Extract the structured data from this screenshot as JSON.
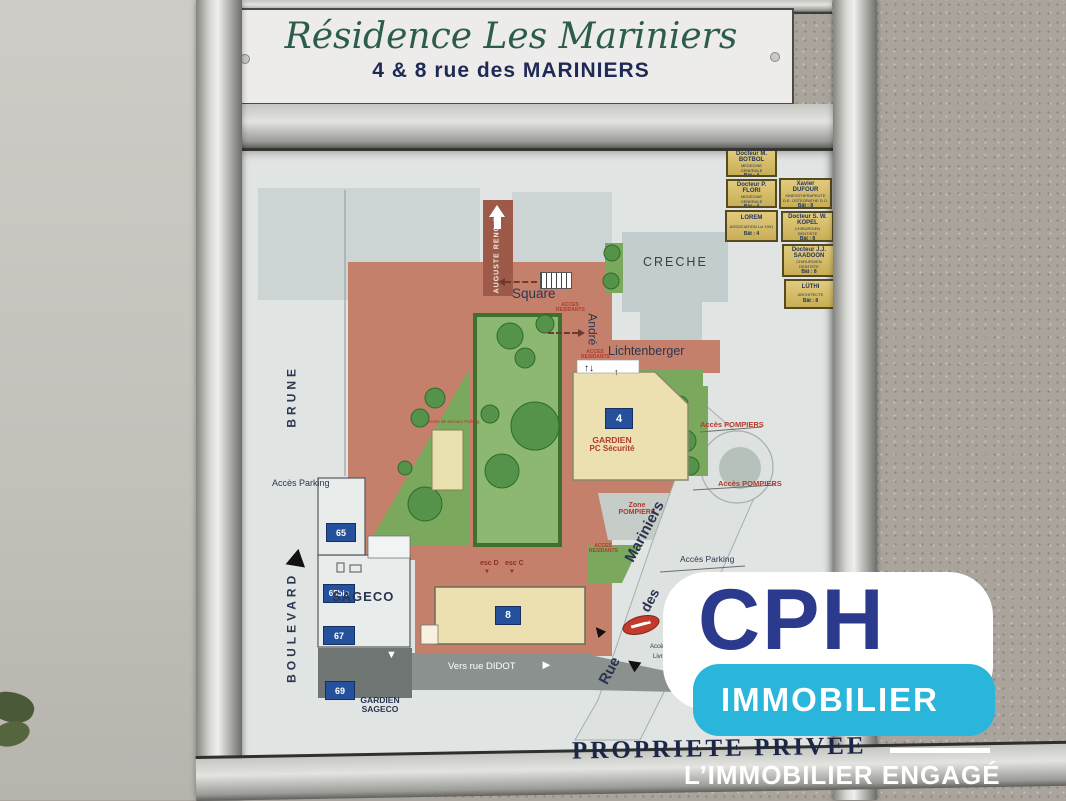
{
  "sign": {
    "title": "Résidence Les Mariniers",
    "subtitle": "4 & 8 rue des MARINIERS"
  },
  "directory": [
    {
      "name": "Docteur M. BOTBOL",
      "specialty": "MEDECINE GENERALE",
      "bat": "Bât : 4"
    },
    {
      "name": "Docteur P. FLORI",
      "specialty": "MEDECINE GENERALE",
      "bat": "Bât : 4"
    },
    {
      "name": "LOREM",
      "specialty": "ASSOCIATION Loi 1901",
      "bat": "Bât : 4"
    },
    {
      "name": "Xavier DUFOUR",
      "specialty": "KINESITHERAPEUTE D.E. OSTEOPATHE D.O.",
      "bat": "Bât : 8"
    },
    {
      "name": "Docteur S. W. KOPEL",
      "specialty": "CHIRURGIEN DENTISTE",
      "bat": "Bât : 8"
    },
    {
      "name": "Docteur J.J. SAADOON",
      "specialty": "CHIRURGIEN DENTISTE",
      "bat": "Bât : 8"
    },
    {
      "name": "LÜTHI",
      "specialty": "ARCHITECTE",
      "bat": "Bât : 8"
    }
  ],
  "map": {
    "streets": {
      "boulevard": "BOULEVARD",
      "brune": "BRUNE",
      "auguste_renoir": "AUGUSTE RENOIR",
      "rue": "Rue",
      "des": "des",
      "mariniers": "Mariniers",
      "vers_didot": "Vers rue DIDOT"
    },
    "places": {
      "square": "Square",
      "andre": "André",
      "lichtenberger": "Lichtenberger",
      "creche": "CRECHE",
      "sageco": "SAGECO",
      "gardien_line1": "GARDIEN",
      "gardien_line2": "SAGECO"
    },
    "labels": {
      "acces_parking_west": "Accès Parking",
      "acces_parking_east": "Accès Parking",
      "acces_pompiers_north": "Accès POMPIERS",
      "acces_pompiers_south": "Accès POMPIERS",
      "zone_line1": "Zone",
      "zone_line2": "POMPIERS",
      "acces_res_l1": "ACCES",
      "acces_res_l2": "RESIDANTS",
      "gardien": "GARDIEN",
      "pc_securite": "PC Sécurité",
      "esc_d": "esc D",
      "esc_c": "esc C",
      "sortie_secours": "Sortie de secours Parking",
      "zone_cut": "Zone",
      "acces_cut": "Accès V",
      "livraisons_cut": "Livra"
    },
    "plates": {
      "b4": "4",
      "b8": "8",
      "n65": "65",
      "n65bis": "65bis",
      "n67": "67",
      "n69": "69"
    }
  },
  "footer": {
    "notice": "PROPRIETE PRIVEE"
  },
  "brand": {
    "name": "CPH",
    "division": "IMMOBILIER",
    "tagline": "L’IMMOBILIER ENGAGÉ"
  },
  "icons": {
    "up_down": "↑↓",
    "up": "↑",
    "right": "►",
    "down": "▼"
  },
  "colors": {
    "plan_ground": "#c5806c",
    "plan_green": "#7aa95e",
    "building": "#ecdfb0",
    "plate_blue": "#24509c",
    "label_red": "#b03a2e",
    "brand_navy": "#2b3a8c",
    "brand_cyan": "#2ab5da",
    "title_green": "#2c5d4c",
    "title_navy": "#1e2a55"
  }
}
